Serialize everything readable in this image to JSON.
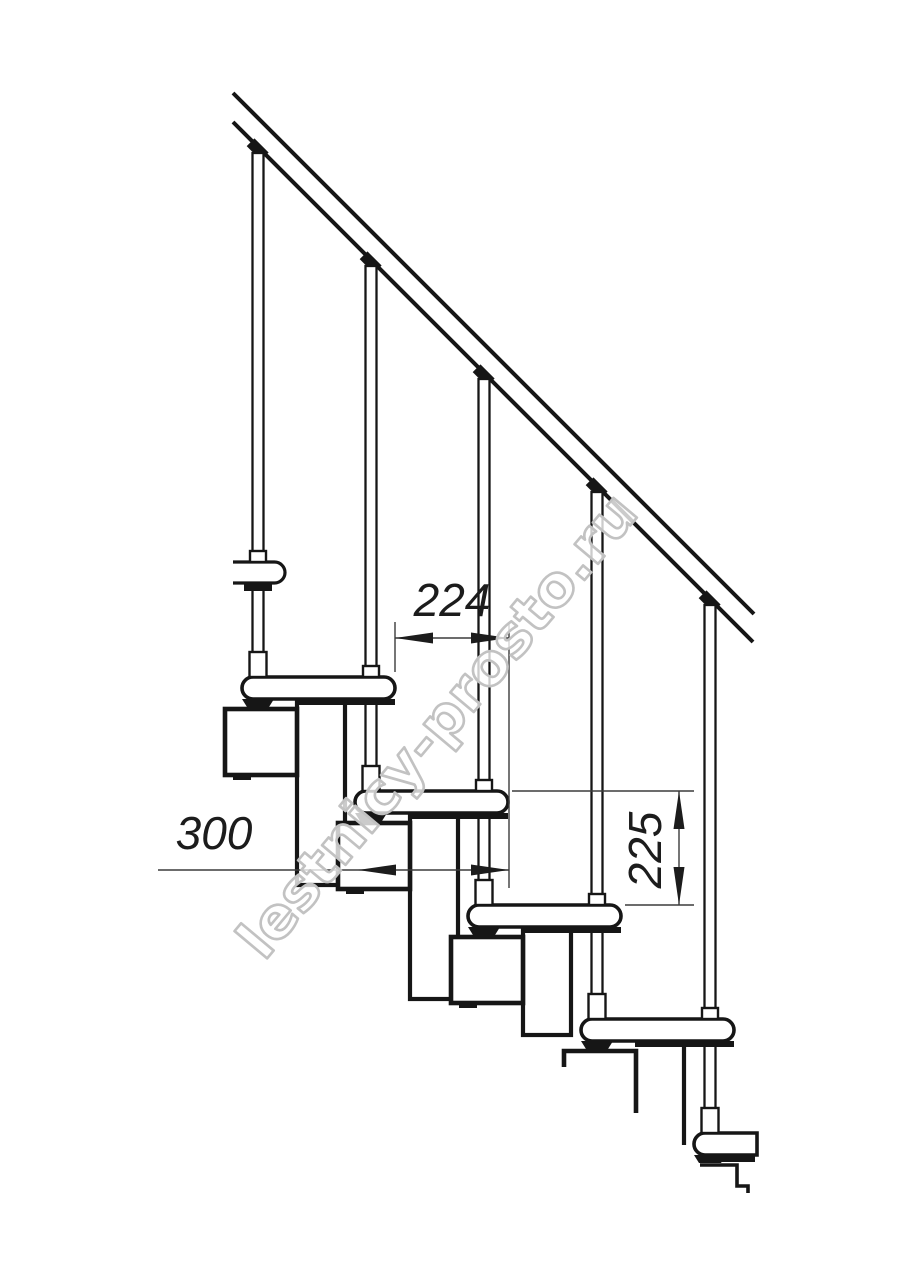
{
  "meta": {
    "kind": "technical-drawing",
    "subject": "modular staircase side elevation",
    "background": "#ffffff",
    "line_color": "#161616",
    "dim_line_color": "#3c3c3c",
    "dim_text_color": "#1c1c1c"
  },
  "watermark": {
    "text": "lestnicy-prosto.ru",
    "stroke_color": "#c2c2c2",
    "fill_color": "#ffffff",
    "fill_opacity": 0.78,
    "angle": -50,
    "cx": 452,
    "cy": 738,
    "font_size": 56,
    "text_length": 585
  },
  "dimensions": {
    "font_size": 46,
    "step_run": {
      "value": "224",
      "line_y": 638,
      "x1": 395,
      "x2": 509,
      "label_x": 452,
      "label_y": 616
    },
    "tread_depth": {
      "value": "300",
      "line_y": 870,
      "x1": 158,
      "x2": 509,
      "arrow_left_x": 358,
      "label_x": 214,
      "label_y": 849
    },
    "step_rise": {
      "value": "225",
      "line_x": 679,
      "y1": 791,
      "y2": 905,
      "label_x": 661,
      "label_y": 850
    },
    "ext_lines_v": [
      {
        "x": 395,
        "y1": 622,
        "y2": 672
      },
      {
        "x": 509,
        "y1": 622,
        "y2": 888
      }
    ],
    "ext_lines_h": [
      {
        "y": 791,
        "x1": 512,
        "x2": 694
      },
      {
        "y": 905,
        "x1": 625,
        "x2": 694
      }
    ]
  },
  "drawing": {
    "rail": {
      "x1": 233,
      "x2": 754,
      "upper_c": -140,
      "lower_c": -111,
      "stroke_w": 4
    },
    "steps": [
      {
        "nose": 242,
        "top": 677
      },
      {
        "nose": 355,
        "top": 791
      },
      {
        "nose": 468,
        "top": 905
      },
      {
        "nose": 581,
        "top": 1019
      },
      {
        "nose": 694,
        "top": 1133
      }
    ],
    "tread": {
      "depth": 153,
      "height": 22,
      "radius": 11,
      "stroke_w": 3.6
    },
    "top_tread": {
      "x1": 233,
      "x2": 285,
      "y": 562,
      "height": 21
    },
    "baluster": {
      "nose_offset": 16,
      "width": 11,
      "stroke_w": 2.3
    },
    "module_box": {
      "dx": -17,
      "dy": 32,
      "w": 72,
      "h": 66,
      "stroke_w": 4.6
    },
    "module_tube": {
      "dx": 55,
      "dy": 23,
      "w": 48,
      "h_long": 185,
      "h_short": 107,
      "stroke_w": 4.2
    },
    "partial_box_t5": "M 564,1067 L 564,1051 L 636,1051 L 636,1113",
    "partial_box_t6": "M 700,1165 L 737,1165 L 737,1186 L 748,1186 L 748,1193",
    "tail_line": {
      "x": 684,
      "y1": 1042,
      "y2": 1145
    }
  }
}
